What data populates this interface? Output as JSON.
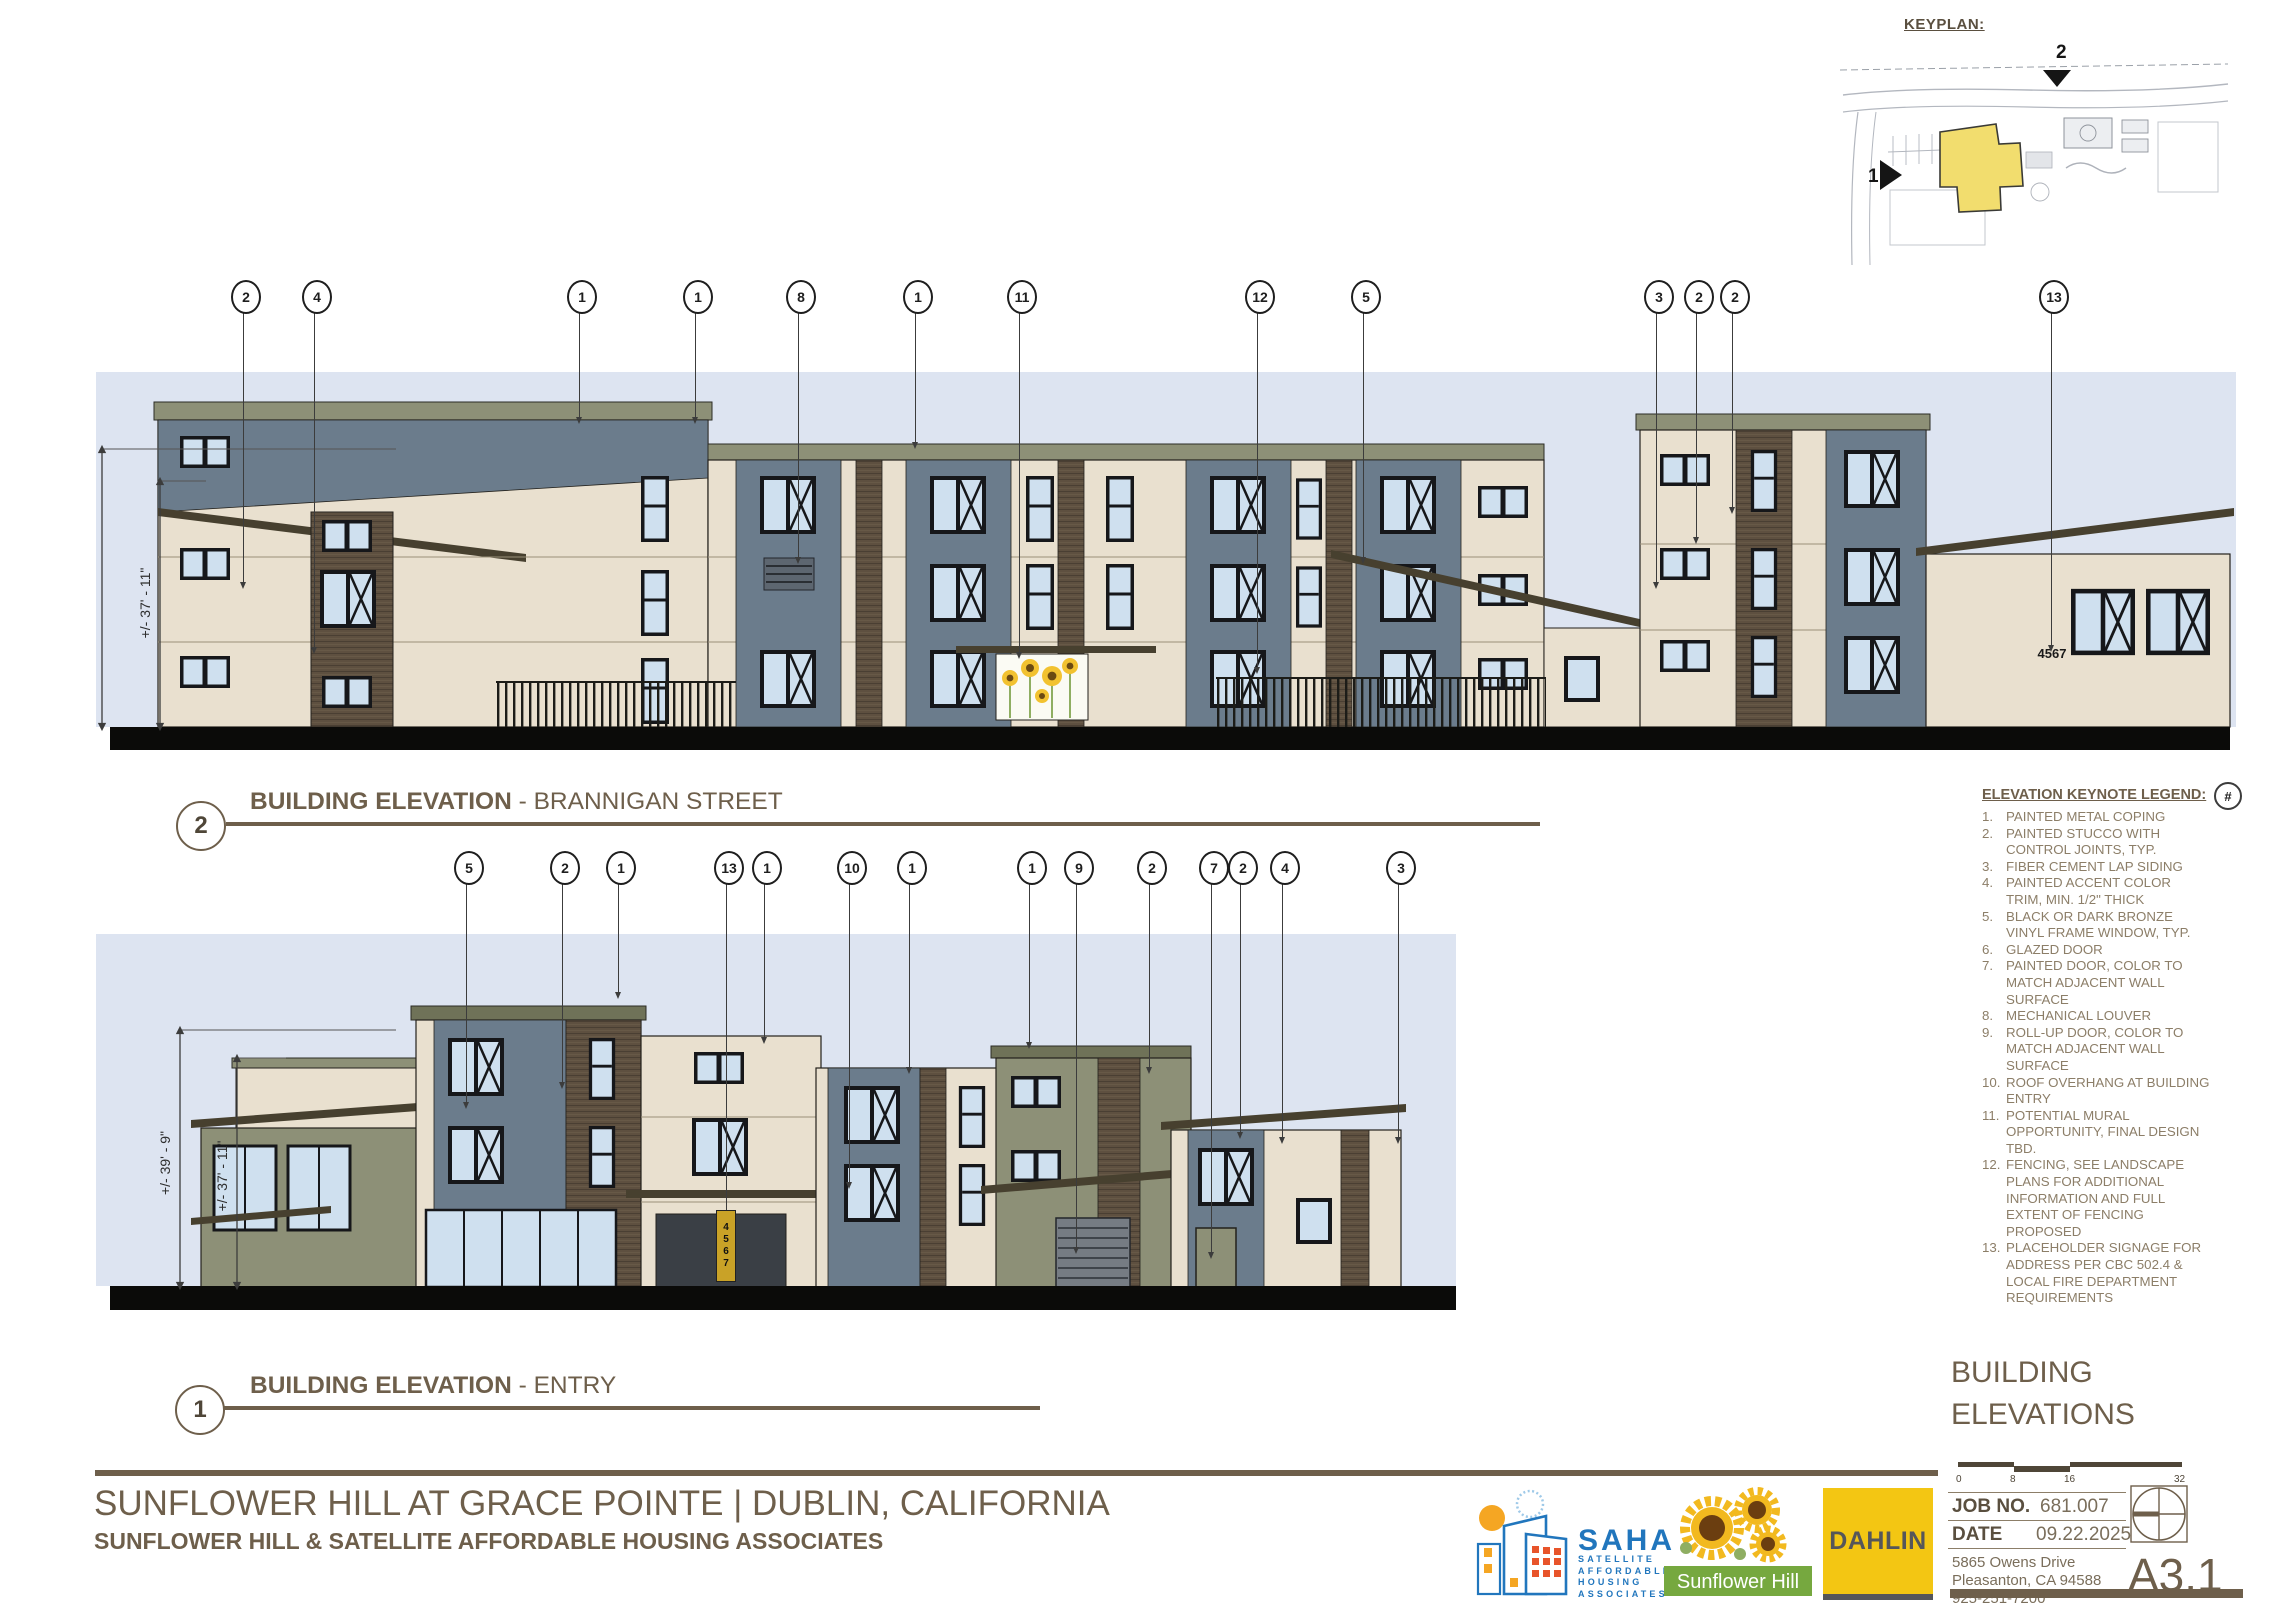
{
  "keyplan": {
    "label": "KEYPLAN:",
    "marker_top": "2",
    "marker_left": "1"
  },
  "elevations": {
    "brannigan": {
      "bubble": "2",
      "title": "BUILDING ELEVATION",
      "subtitle": "- BRANNIGAN STREET",
      "dim_outer": "+/- 39' - 9\"",
      "dim_inner": "+/- 37' - 11\"",
      "address_sign": "4567",
      "callouts": [
        "2",
        "4",
        "1",
        "1",
        "8",
        "1",
        "11",
        "12",
        "5",
        "3",
        "2",
        "2",
        "13"
      ]
    },
    "entry": {
      "bubble": "1",
      "title": "BUILDING ELEVATION",
      "subtitle": "- ENTRY",
      "dim_outer": "+/- 39' - 9\"",
      "dim_inner": "+/- 37' - 11\"",
      "address_sign": "4567",
      "callouts": [
        "5",
        "2",
        "1",
        "13",
        "1",
        "10",
        "1",
        "1",
        "9",
        "2",
        "7",
        "2",
        "4",
        "3"
      ]
    }
  },
  "legend": {
    "title": "ELEVATION KEYNOTE LEGEND:",
    "symbol": "#",
    "items": [
      {
        "n": "1.",
        "text": "PAINTED METAL COPING"
      },
      {
        "n": "2.",
        "text": "PAINTED STUCCO WITH CONTROL JOINTS, TYP."
      },
      {
        "n": "3.",
        "text": "FIBER CEMENT LAP SIDING"
      },
      {
        "n": "4.",
        "text": "PAINTED ACCENT COLOR TRIM, MIN. 1/2\" THICK"
      },
      {
        "n": "5.",
        "text": "BLACK OR DARK BRONZE VINYL FRAME WINDOW, TYP."
      },
      {
        "n": "6.",
        "text": "GLAZED DOOR"
      },
      {
        "n": "7.",
        "text": "PAINTED DOOR, COLOR TO MATCH ADJACENT WALL SURFACE"
      },
      {
        "n": "8.",
        "text": "MECHANICAL LOUVER"
      },
      {
        "n": "9.",
        "text": "ROLL-UP DOOR, COLOR TO MATCH ADJACENT WALL SURFACE"
      },
      {
        "n": "10.",
        "text": "ROOF OVERHANG AT BUILDING ENTRY"
      },
      {
        "n": "11.",
        "text": "POTENTIAL MURAL OPPORTUNITY, FINAL DESIGN TBD."
      },
      {
        "n": "12.",
        "text": "FENCING, SEE LANDSCAPE PLANS FOR ADDITIONAL INFORMATION AND FULL EXTENT OF FENCING PROPOSED"
      },
      {
        "n": "13.",
        "text": "PLACEHOLDER SIGNAGE FOR ADDRESS PER CBC 502.4 & LOCAL FIRE DEPARTMENT REQUIREMENTS"
      }
    ]
  },
  "title_block": {
    "section_title_line1": "BUILDING",
    "section_title_line2": "ELEVATIONS",
    "scale_ticks": [
      "0",
      "8",
      "16",
      "32"
    ],
    "job_label": "JOB NO.",
    "job_value": "681.007",
    "date_label": "DATE",
    "date_value": "09.22.2025",
    "address_line1": "5865 Owens Drive",
    "address_line2": "Pleasanton, CA 94588",
    "phone": "925-251-7200",
    "sheet_number": "A3.1"
  },
  "footer": {
    "project_title": "SUNFLOWER HILL AT GRACE POINTE  |  DUBLIN, CALIFORNIA",
    "project_subtitle": "SUNFLOWER HILL & SATELLITE AFFORDABLE HOUSING ASSOCIATES"
  },
  "logos": {
    "saha": {
      "name": "SAHA",
      "line1": "SATELLITE",
      "line2": "AFFORDABLE",
      "line3": "HOUSING",
      "line4": "ASSOCIATES"
    },
    "sunflower_hill": {
      "name": "Sunflower Hill"
    },
    "dahlin": {
      "name": "DAHLIN"
    }
  },
  "colors": {
    "sky": "#dde4f1",
    "wall_cream": "#e9e0cf",
    "panel_blue_gray": "#6b7c8c",
    "sage_green": "#8d9077",
    "wood_brown": "#5e5040",
    "roof_dark": "#47402f",
    "glass": "#cfe0ef",
    "ground_black": "#0b0b09",
    "annotation_brown": "#6e5f4b",
    "legend_text": "#8c7e68",
    "keyplan_yellow": "#f2dd6e",
    "dahlin_yellow": "#f3c613",
    "saha_blue": "#2176bd",
    "saha_orange": "#f5a623",
    "sunflower_green": "#76a83f",
    "sign_yellow": "#c9a227"
  }
}
